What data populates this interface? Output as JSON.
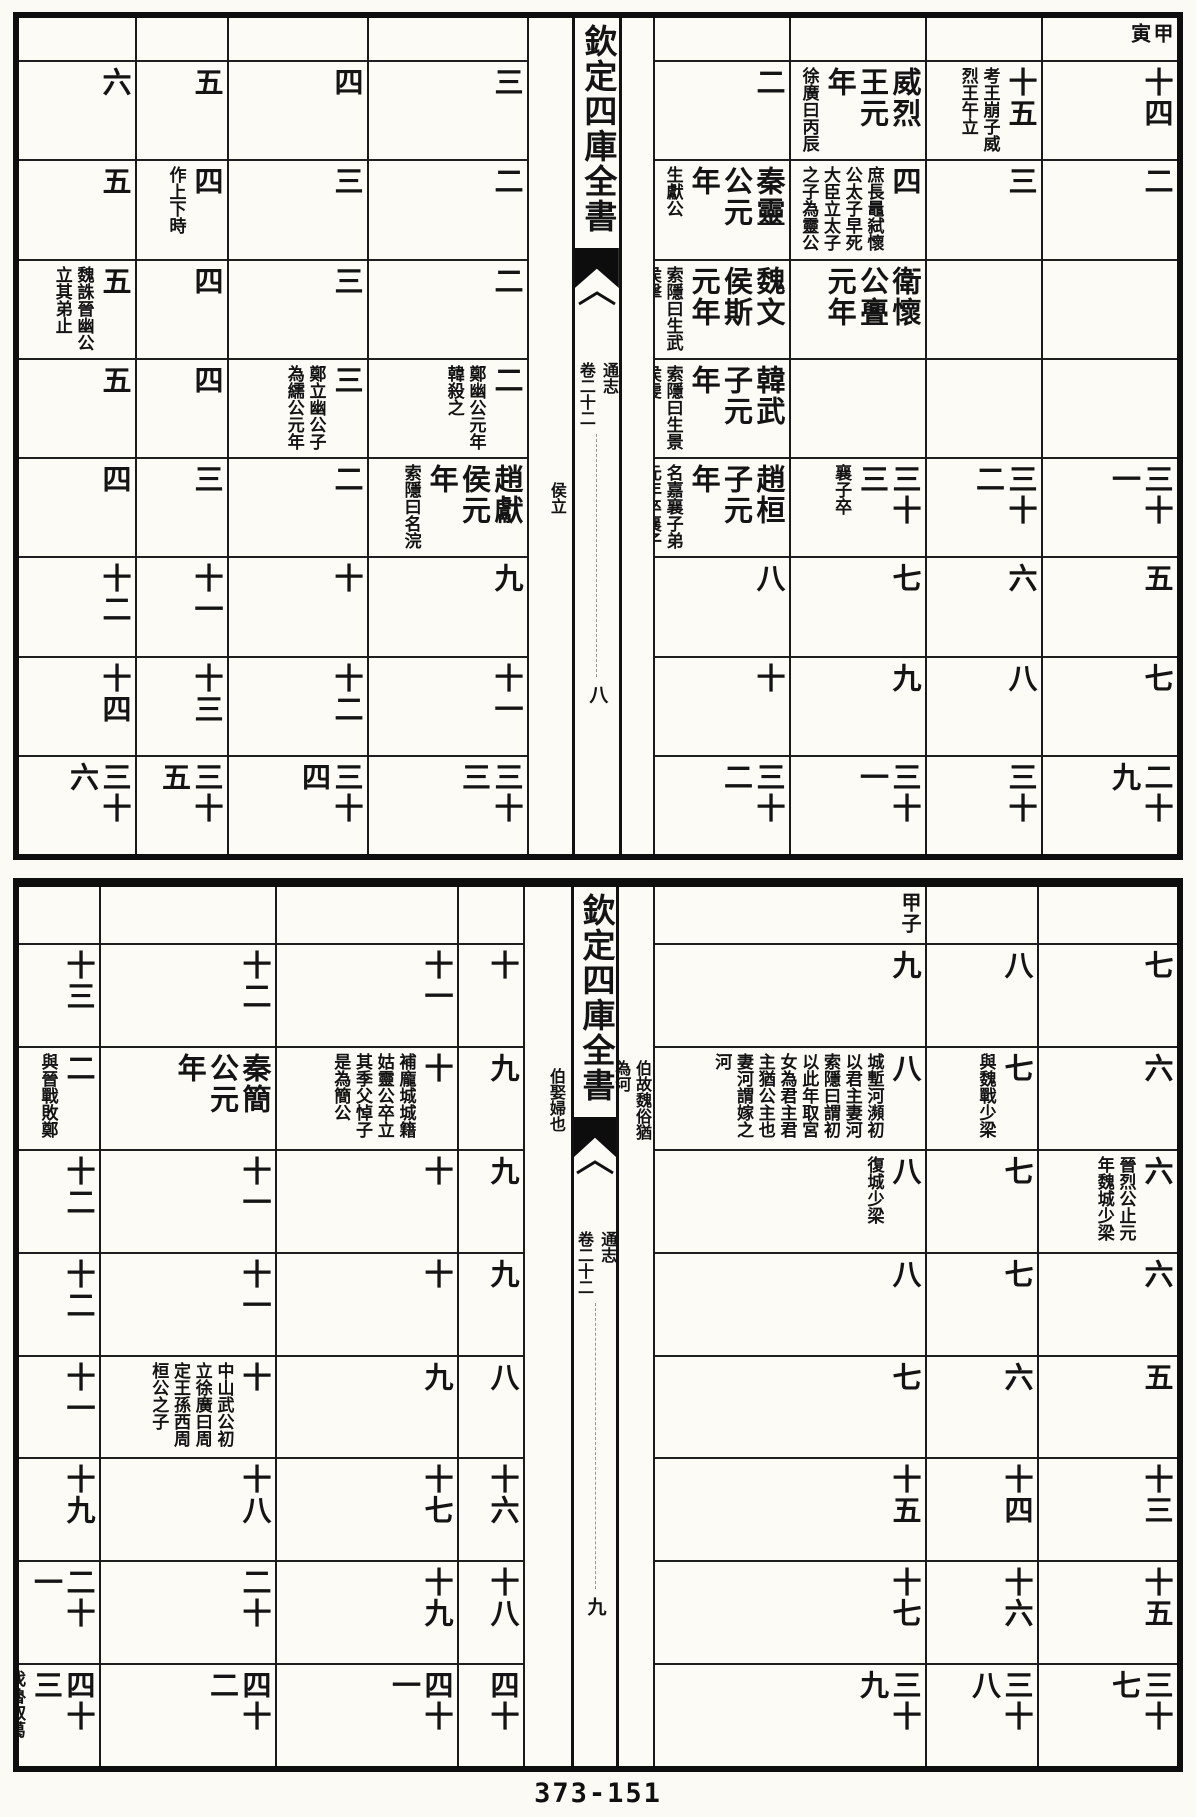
{
  "page_number": "373-151",
  "blocks": [
    {
      "name": "upper-table",
      "spine": {
        "title": "欽定四庫全書",
        "work": "通志",
        "juan": "卷二十二",
        "folio": "八",
        "fishtail_icon": "black-fishtail"
      },
      "right_page_columns": 4,
      "gutter_notes": {
        "left": [
          {
            "row": 4,
            "text": "侯立"
          }
        ],
        "right": []
      },
      "columns": [
        {
          "ganzhi": "甲寅",
          "cells": [
            {
              "main": "十四"
            },
            {
              "main": "二"
            },
            {},
            {},
            {
              "main": "三十一"
            },
            {
              "main": "五"
            },
            {
              "main": "七"
            },
            {
              "main": "二十九"
            }
          ]
        },
        {
          "ganzhi": "",
          "cells": [
            {
              "main": "十五",
              "note": "考王崩子威烈王午立"
            },
            {
              "main": "三"
            },
            {},
            {},
            {
              "main": "三十二"
            },
            {
              "main": "六"
            },
            {
              "main": "八"
            },
            {
              "main": "三十"
            }
          ]
        },
        {
          "ganzhi": "",
          "cells": [
            {
              "main": "威烈王元年",
              "note": "徐廣曰丙辰"
            },
            {
              "main": "四",
              "note": "庶長鼂弑懷公太子早死大臣立太子之子為靈公"
            },
            {
              "main": "衛懷公亹元年"
            },
            {},
            {
              "main": "三十三",
              "note": "襄子卒"
            },
            {
              "main": "七"
            },
            {
              "main": "九"
            },
            {
              "main": "三十一"
            }
          ]
        },
        {
          "ganzhi": "",
          "cells": [
            {
              "main": "二"
            },
            {
              "main": "秦靈公元年",
              "note": "生獻公"
            },
            {
              "main": "魏文侯斯元年",
              "note": "索隱曰生武侯擊"
            },
            {
              "main": "韓武子元年",
              "note": "索隱曰生景侯虔"
            },
            {
              "main": "趙桓子元年",
              "note": "名嘉襄子弟元年卒襄子子獻"
            },
            {
              "main": "八"
            },
            {
              "main": "十"
            },
            {
              "main": "三十二"
            }
          ]
        },
        {
          "ganzhi": "",
          "cells": [
            {
              "main": "三"
            },
            {
              "main": "二"
            },
            {
              "main": "二"
            },
            {
              "main": "二",
              "note": "鄭幽公元年韓殺之"
            },
            {
              "main": "趙獻侯元年",
              "note": "索隱曰名浣"
            },
            {
              "main": "九"
            },
            {
              "main": "十一"
            },
            {
              "main": "三十三"
            }
          ]
        },
        {
          "ganzhi": "",
          "cells": [
            {
              "main": "四"
            },
            {
              "main": "三"
            },
            {
              "main": "三"
            },
            {
              "main": "三",
              "note": "鄭立幽公子為繻公元年"
            },
            {
              "main": "二"
            },
            {
              "main": "十"
            },
            {
              "main": "十二"
            },
            {
              "main": "三十四"
            }
          ]
        },
        {
          "ganzhi": "",
          "cells": [
            {
              "main": "五"
            },
            {
              "main": "四",
              "note": "作上下時"
            },
            {
              "main": "四"
            },
            {
              "main": "四"
            },
            {
              "main": "三"
            },
            {
              "main": "十一"
            },
            {
              "main": "十三"
            },
            {
              "main": "三十五"
            }
          ]
        },
        {
          "ganzhi": "",
          "cells": [
            {
              "main": "六"
            },
            {
              "main": "五"
            },
            {
              "main": "五",
              "note": "魏誅晉幽公立其弟止"
            },
            {
              "main": "五"
            },
            {
              "main": "四"
            },
            {
              "main": "十二"
            },
            {
              "main": "十四"
            },
            {
              "main": "三十六"
            }
          ]
        }
      ]
    },
    {
      "name": "lower-table",
      "spine": {
        "title": "欽定四庫全書",
        "work": "通志",
        "juan": "卷二十二",
        "folio": "九",
        "fishtail_icon": "black-fishtail"
      },
      "right_page_columns": 3,
      "gutter_notes": {
        "left": [
          {
            "row": 1,
            "text": "伯娶婦也"
          }
        ],
        "right": [
          {
            "row": 1,
            "text": "伯故魏俗猶為河"
          }
        ]
      },
      "columns": [
        {
          "ganzhi": "",
          "cells": [
            {
              "main": "七"
            },
            {
              "main": "六"
            },
            {
              "main": "六",
              "note": "晉烈公止元年魏城少梁"
            },
            {
              "main": "六"
            },
            {
              "main": "五"
            },
            {
              "main": "十三"
            },
            {
              "main": "十五"
            },
            {
              "main": "三十七"
            }
          ]
        },
        {
          "ganzhi": "",
          "cells": [
            {
              "main": "八"
            },
            {
              "main": "七",
              "note": "與魏戰少梁"
            },
            {
              "main": "七"
            },
            {
              "main": "七"
            },
            {
              "main": "六"
            },
            {
              "main": "十四"
            },
            {
              "main": "十六"
            },
            {
              "main": "三十八"
            }
          ]
        },
        {
          "ganzhi": "甲子",
          "cells": [
            {
              "main": "九"
            },
            {
              "main": "八",
              "note": "城塹河瀕初以君主妻河索隱曰謂初以此年取宮女為君主君主猶公主也妻河謂嫁之河"
            },
            {
              "main": "八",
              "note": "復城少梁"
            },
            {
              "main": "八"
            },
            {
              "main": "七"
            },
            {
              "main": "十五"
            },
            {
              "main": "十七"
            },
            {
              "main": "三十九"
            }
          ]
        },
        {
          "ganzhi": "",
          "cells": [
            {
              "main": "十"
            },
            {
              "main": "九"
            },
            {
              "main": "九"
            },
            {
              "main": "九"
            },
            {
              "main": "八"
            },
            {
              "main": "十六"
            },
            {
              "main": "十八"
            },
            {
              "main": "四十"
            }
          ]
        },
        {
          "ganzhi": "",
          "cells": [
            {
              "main": "十一"
            },
            {
              "main": "十",
              "note": "補龐城城籍姑靈公卒立其季父悼子是為簡公"
            },
            {
              "main": "十"
            },
            {
              "main": "十"
            },
            {
              "main": "九"
            },
            {
              "main": "十七"
            },
            {
              "main": "十九"
            },
            {
              "main": "四十一"
            }
          ]
        },
        {
          "ganzhi": "",
          "cells": [
            {
              "main": "十二"
            },
            {
              "main": "秦簡公元年"
            },
            {
              "main": "十一"
            },
            {
              "main": "十一"
            },
            {
              "main": "十",
              "note": "中山武公初立徐廣曰周定王孫西周桓公之子"
            },
            {
              "main": "十八"
            },
            {
              "main": "二十"
            },
            {
              "main": "四十二"
            }
          ]
        },
        {
          "ganzhi": "",
          "cells": [
            {
              "main": "十三"
            },
            {
              "main": "二",
              "note": "與晉戰敗鄭"
            },
            {
              "main": "十二"
            },
            {
              "main": "十二"
            },
            {
              "main": "十一"
            },
            {
              "main": "十九"
            },
            {
              "main": "二十一"
            },
            {
              "main": "四十三",
              "note": "伐魯取葛"
            }
          ]
        }
      ]
    }
  ]
}
